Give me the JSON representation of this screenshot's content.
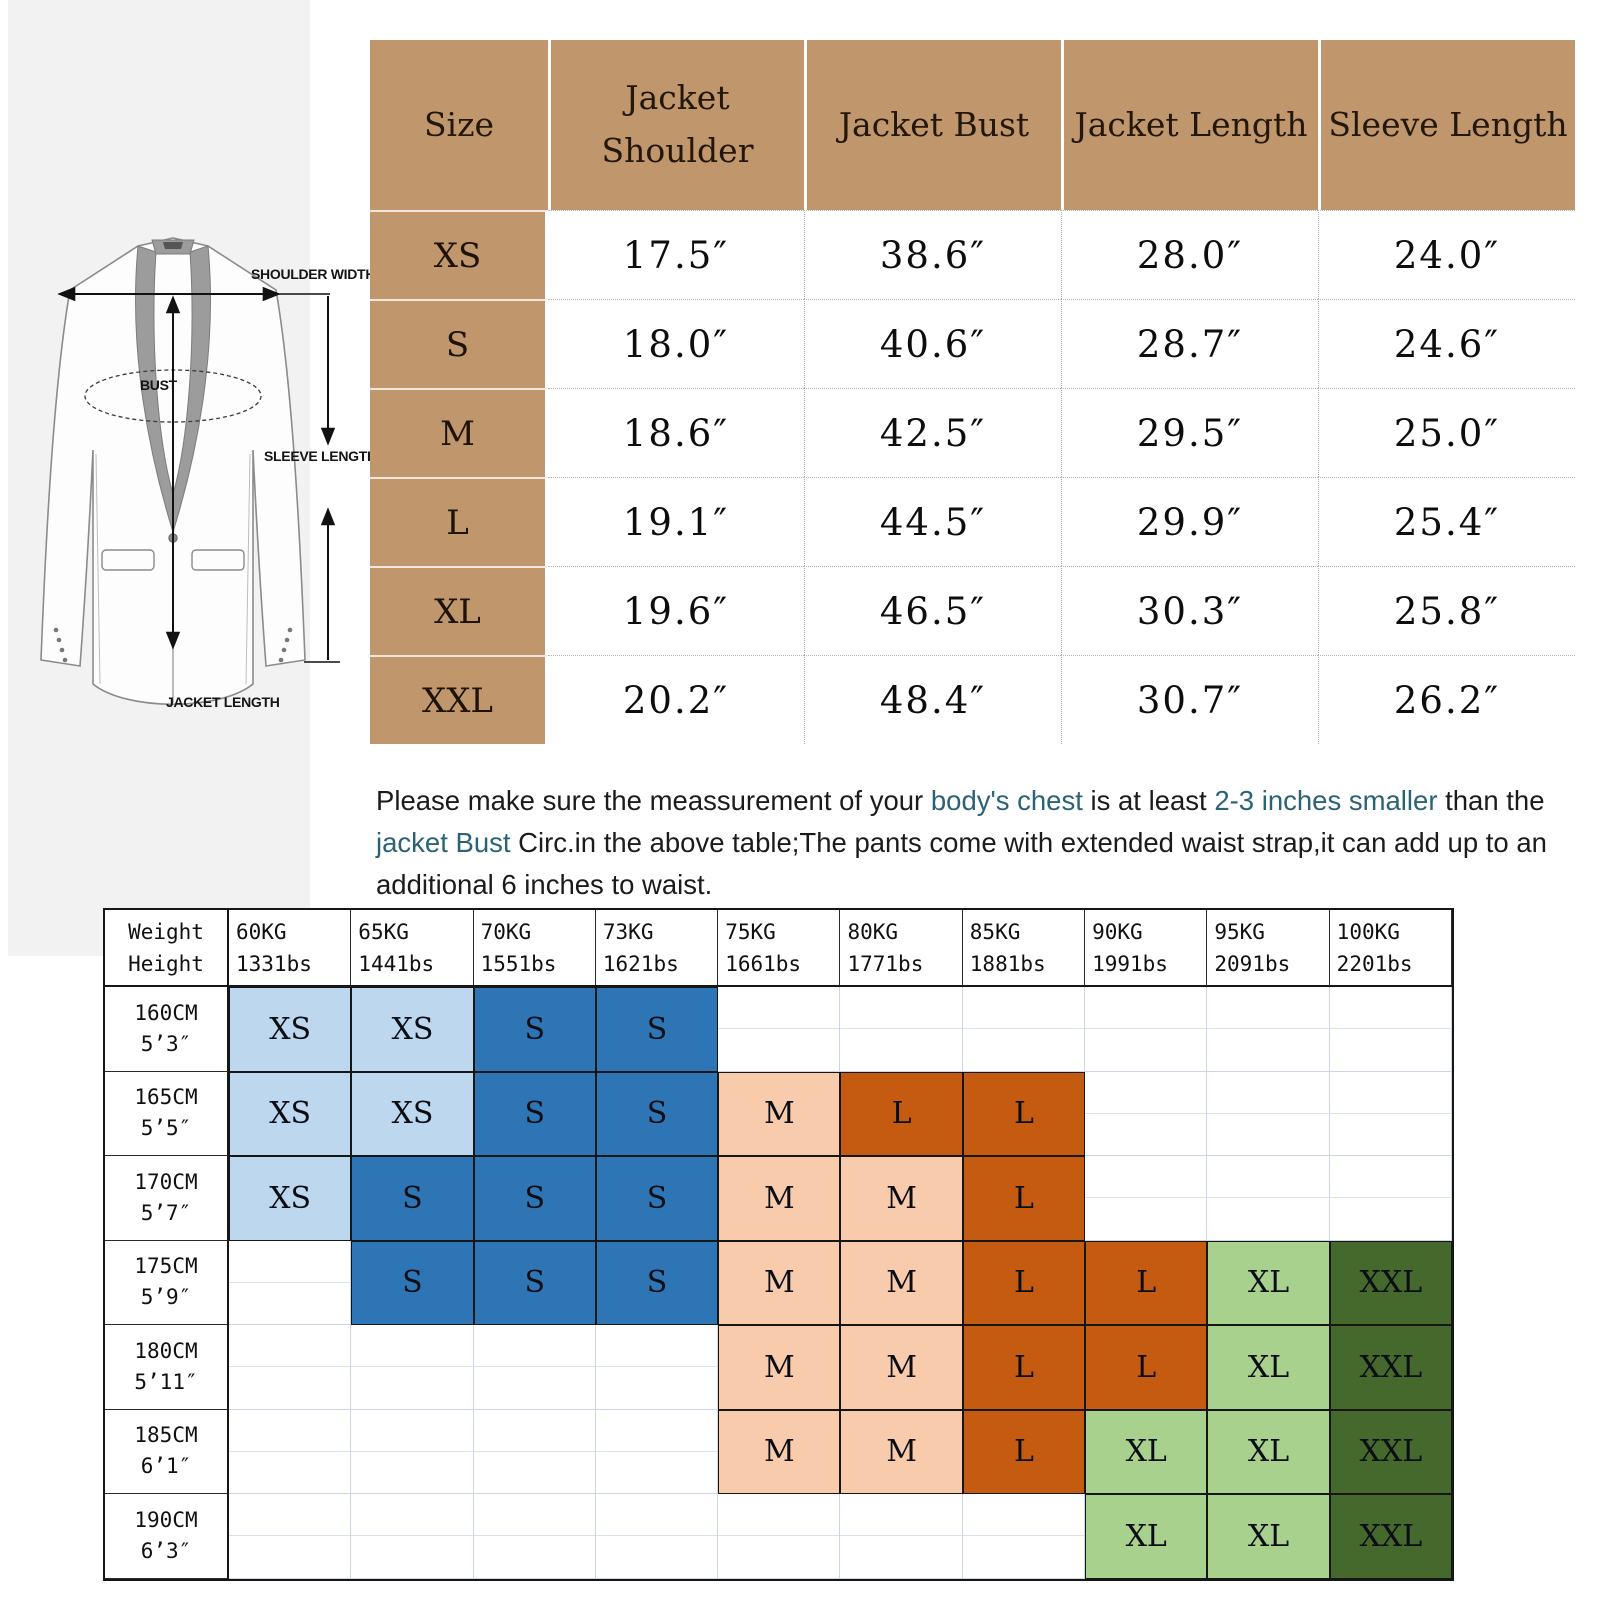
{
  "diagram": {
    "labels": {
      "shoulder_width": "SHOULDER WIDTH",
      "bust": "BUST",
      "sleeve_length": "SLEEVE LENGTH",
      "jacket_length": "JACKET LENGTH"
    }
  },
  "size_table": {
    "header_bg": "#c0976c",
    "columns": [
      "Size",
      "Jacket Shoulder",
      "Jacket Bust",
      "Jacket Length",
      "Sleeve Length"
    ],
    "rows": [
      {
        "size": "XS",
        "values": [
          "17.5″",
          "38.6″",
          "28.0″",
          "24.0″"
        ]
      },
      {
        "size": "S",
        "values": [
          "18.0″",
          "40.6″",
          "28.7″",
          "24.6″"
        ]
      },
      {
        "size": "M",
        "values": [
          "18.6″",
          "42.5″",
          "29.5″",
          "25.0″"
        ]
      },
      {
        "size": "L",
        "values": [
          "19.1″",
          "44.5″",
          "29.9″",
          "25.4″"
        ]
      },
      {
        "size": "XL",
        "values": [
          "19.6″",
          "46.5″",
          "30.3″",
          "25.8″"
        ]
      },
      {
        "size": "XXL",
        "values": [
          "20.2″",
          "48.4″",
          "30.7″",
          "26.2″"
        ]
      }
    ]
  },
  "note": {
    "segments": [
      {
        "text": "Please make sure the meassurement of your ",
        "style": "normal"
      },
      {
        "text": "body's chest",
        "style": "teal"
      },
      {
        "text": " is at least ",
        "style": "normal"
      },
      {
        "text": "2-3 inches smaller",
        "style": "teal"
      },
      {
        "text": " than the ",
        "style": "normal"
      },
      {
        "text": "jacket Bust",
        "style": "teal"
      },
      {
        "text": " Circ.in the above table;The pants come with extended waist strap,it can add up to an additional 6 inches to waist.",
        "style": "normal"
      }
    ],
    "accent_color": "#2b6376"
  },
  "fit_table": {
    "corner": {
      "top": "Weight",
      "bottom": "Height"
    },
    "weights": [
      {
        "kg": "60KG",
        "lbs": "1331bs"
      },
      {
        "kg": "65KG",
        "lbs": "1441bs"
      },
      {
        "kg": "70KG",
        "lbs": "1551bs"
      },
      {
        "kg": "73KG",
        "lbs": "1621bs"
      },
      {
        "kg": "75KG",
        "lbs": "1661bs"
      },
      {
        "kg": "80KG",
        "lbs": "1771bs"
      },
      {
        "kg": "85KG",
        "lbs": "1881bs"
      },
      {
        "kg": "90KG",
        "lbs": "1991bs"
      },
      {
        "kg": "95KG",
        "lbs": "2091bs"
      },
      {
        "kg": "100KG",
        "lbs": "2201bs"
      }
    ],
    "heights": [
      {
        "cm": "160CM",
        "ft": "5’3″"
      },
      {
        "cm": "165CM",
        "ft": "5’5″"
      },
      {
        "cm": "170CM",
        "ft": "5’7″"
      },
      {
        "cm": "175CM",
        "ft": "5’9″"
      },
      {
        "cm": "180CM",
        "ft": "5’11″"
      },
      {
        "cm": "185CM",
        "ft": "6’1″"
      },
      {
        "cm": "190CM",
        "ft": "6’3″"
      }
    ],
    "colors": {
      "lightblue": "#BDD7EE",
      "blue": "#2E75B6",
      "peach": "#F8CBAD",
      "orange": "#C55A11",
      "lightgreen": "#A9D18E",
      "darkgreen": "#45682D"
    },
    "cells": [
      [
        {
          "label": "XS",
          "color": "lightblue"
        },
        {
          "label": "XS",
          "color": "lightblue"
        },
        {
          "label": "S",
          "color": "blue"
        },
        {
          "label": "S",
          "color": "blue"
        },
        null,
        null,
        null,
        null,
        null,
        null
      ],
      [
        {
          "label": "XS",
          "color": "lightblue"
        },
        {
          "label": "XS",
          "color": "lightblue"
        },
        {
          "label": "S",
          "color": "blue"
        },
        {
          "label": "S",
          "color": "blue"
        },
        {
          "label": "M",
          "color": "peach"
        },
        {
          "label": "L",
          "color": "orange"
        },
        {
          "label": "L",
          "color": "orange"
        },
        null,
        null,
        null
      ],
      [
        {
          "label": "XS",
          "color": "lightblue"
        },
        {
          "label": "S",
          "color": "blue"
        },
        {
          "label": "S",
          "color": "blue"
        },
        {
          "label": "S",
          "color": "blue"
        },
        {
          "label": "M",
          "color": "peach"
        },
        {
          "label": "M",
          "color": "peach"
        },
        {
          "label": "L",
          "color": "orange"
        },
        null,
        null,
        null
      ],
      [
        null,
        {
          "label": "S",
          "color": "blue"
        },
        {
          "label": "S",
          "color": "blue"
        },
        {
          "label": "S",
          "color": "blue"
        },
        {
          "label": "M",
          "color": "peach"
        },
        {
          "label": "M",
          "color": "peach"
        },
        {
          "label": "L",
          "color": "orange"
        },
        {
          "label": "L",
          "color": "orange"
        },
        {
          "label": "XL",
          "color": "lightgreen"
        },
        {
          "label": "XXL",
          "color": "darkgreen"
        }
      ],
      [
        null,
        null,
        null,
        null,
        {
          "label": "M",
          "color": "peach"
        },
        {
          "label": "M",
          "color": "peach"
        },
        {
          "label": "L",
          "color": "orange"
        },
        {
          "label": "L",
          "color": "orange"
        },
        {
          "label": "XL",
          "color": "lightgreen"
        },
        {
          "label": "XXL",
          "color": "darkgreen"
        }
      ],
      [
        null,
        null,
        null,
        null,
        {
          "label": "M",
          "color": "peach"
        },
        {
          "label": "M",
          "color": "peach"
        },
        {
          "label": "L",
          "color": "orange"
        },
        {
          "label": "XL",
          "color": "lightgreen"
        },
        {
          "label": "XL",
          "color": "lightgreen"
        },
        {
          "label": "XXL",
          "color": "darkgreen"
        }
      ],
      [
        null,
        null,
        null,
        null,
        null,
        null,
        null,
        {
          "label": "XL",
          "color": "lightgreen"
        },
        {
          "label": "XL",
          "color": "lightgreen"
        },
        {
          "label": "XXL",
          "color": "darkgreen"
        }
      ]
    ]
  }
}
